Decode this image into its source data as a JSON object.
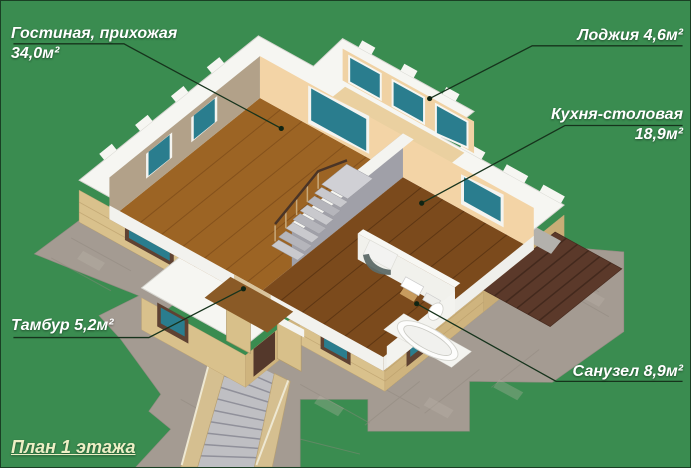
{
  "title": "План 1 этажа",
  "callouts": {
    "living_room": {
      "line1": "Гостиная, прихожая",
      "line2": "34,0м²"
    },
    "loggia": {
      "line1": "Лоджия 4,6м²"
    },
    "kitchen_dining": {
      "line1": "Кухня-столовая",
      "line2": "18,9м²"
    },
    "vestibule": {
      "line1": "Тамбур 5,2м²"
    },
    "bathroom": {
      "line1": "Санузел 8,9м²"
    }
  },
  "colors": {
    "background": "#3a8c50",
    "leader_line": "#16331c",
    "label_text": "#ffffff",
    "title_text": "#edefc5",
    "wall_top_white": "#f6f6f2",
    "wall_interior_peach": "#f3d4a6",
    "wall_shaded_taupe": "#b2a189",
    "floor_living": "#9c6424",
    "floor_kitchen": "#7b4a1c",
    "window_glass_teal": "#2a7d8e",
    "brick": "#d9c18c",
    "paving": "#a49b92",
    "deck": "#5b392a",
    "stairs": "#c9c9cd"
  }
}
